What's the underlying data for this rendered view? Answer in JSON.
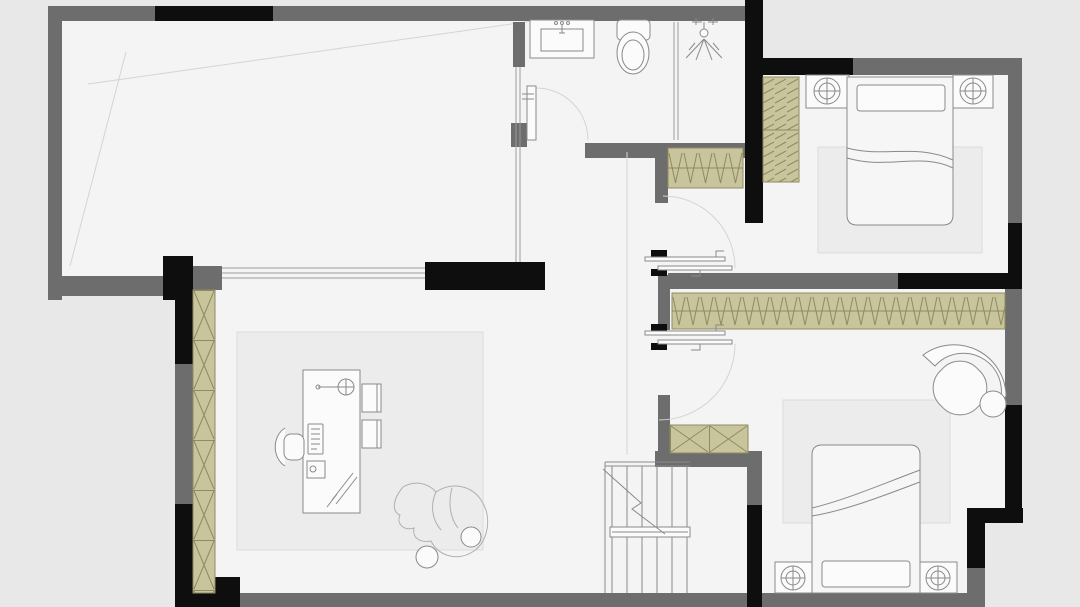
{
  "canvas": {
    "width": 1080,
    "height": 607,
    "viewbox": "0 0 1080 607"
  },
  "colors": {
    "bg": "#e8e8e8",
    "floor": "#f4f4f4",
    "wall": "#6d6d6d",
    "wall_dark": "#0e0e0e",
    "cabinet": "#c8c49c",
    "cabinet_line": "#8f8a60",
    "rug": "#ececec",
    "rug_line": "#dcdcdc",
    "furniture_fill": "#fbfbfb",
    "bed_fill": "#f6f6f6",
    "line": "#8a8a8a",
    "line_faint": "#d4d4d4",
    "glass": "#9b9b9b"
  },
  "elements": {
    "type": "apartment-floor-plan",
    "icons": [
      "double-bed-icon",
      "pillow-icon",
      "nightstand-lamp-icon",
      "toilet-icon",
      "sink-vanity-icon",
      "shower-head-icon",
      "armchair-icon",
      "ottoman-icon",
      "desk-icon",
      "desk-lamp-icon",
      "keyboard-icon",
      "office-chair-icon",
      "guest-chair-icon",
      "person-figure-icon",
      "ball-icon",
      "staircase-icon",
      "wardrobe-hanging-rail-icon",
      "wardrobe-shelf-icon",
      "storage-cabinet-x-icon",
      "door-swing-icon",
      "sliding-door-icon",
      "glass-partition-icon",
      "rug-icon",
      "ceiling-cross-line-icon"
    ]
  }
}
